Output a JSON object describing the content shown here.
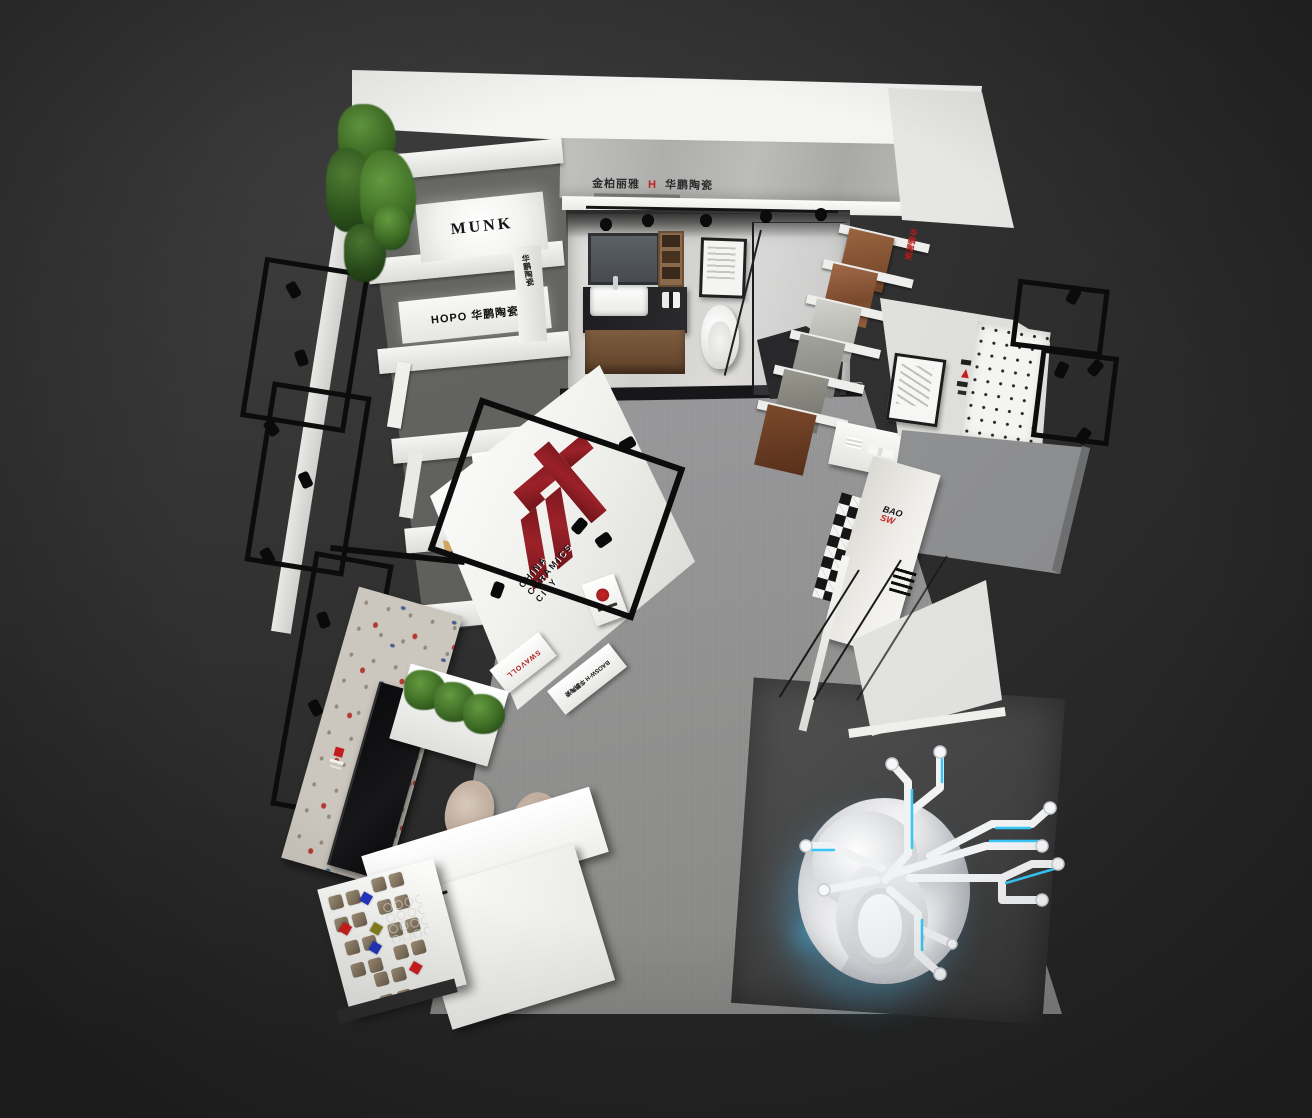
{
  "scene": {
    "title": "Top-down 3D render of a ceramics brand exhibition showroom",
    "background_color": "#2e2e2e"
  },
  "colors": {
    "accent_red": "#b01c1c",
    "logo_red": "#8c1f26",
    "cyan_glow": "#38c6f4",
    "carpet_gray": "#8f8f8d",
    "canopy_gray": "#929396"
  },
  "signs": {
    "header": {
      "left": "金柏丽雅",
      "mark": "H",
      "right": "华鹏陶瓷"
    },
    "munk": "MUNK",
    "hopo": "HOPO 华鹏陶瓷",
    "pillar_vertical": "华鹏陶瓷",
    "rack_vertical": "华鹏陶瓷",
    "logo_wall": {
      "line1": "CHINA",
      "line2": "CERAMICS",
      "line3": "CITY"
    },
    "plaque_red": "SWAVOLL",
    "plaque_black": "BAOSW·H 华鹏陶瓷",
    "counter_line1": "BAO",
    "counter_line2": "SW"
  }
}
